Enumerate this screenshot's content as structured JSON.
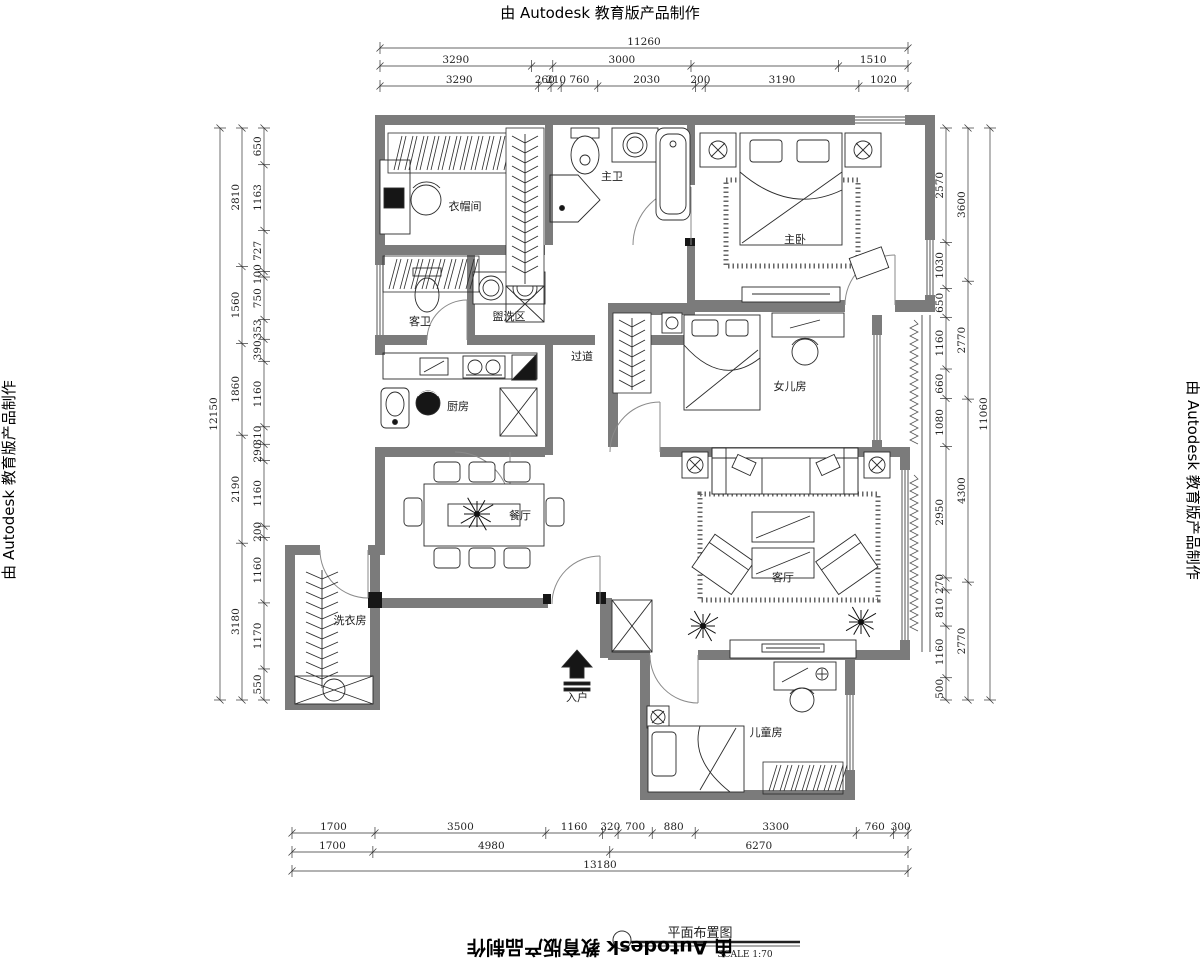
{
  "watermark": {
    "text": "由 Autodesk 教育版产品制作"
  },
  "title": {
    "name": "平面布置图",
    "scale": "SCALE 1:70"
  },
  "rooms": {
    "cloakroom": "衣帽间",
    "master_bath": "主卫",
    "master_bedroom": "主卧",
    "guest_bath": "客卫",
    "wash_area": "盥洗区",
    "corridor": "过道",
    "daughter_room": "女儿房",
    "kitchen": "厨房",
    "dining": "餐厅",
    "living": "客厅",
    "laundry": "洗衣房",
    "entry": "入户",
    "kids_room": "儿童房"
  },
  "colors": {
    "wall": "#7b7b7b",
    "line": "#2b2b2b"
  },
  "dimensions": {
    "top": {
      "total": "11260",
      "row2": [
        "3290",
        "3000",
        "1510"
      ],
      "row3": [
        "3290",
        "260",
        "210",
        "760",
        "2030",
        "200",
        "3190",
        "1020"
      ]
    },
    "bottom": {
      "row1": [
        "1700",
        "3500",
        "1160",
        "320",
        "700",
        "880",
        "3300",
        "760",
        "300"
      ],
      "row2": [
        "1700",
        "4980",
        "6270"
      ],
      "total": "13180"
    },
    "left": {
      "total": "12150",
      "mid": [
        "2810",
        "1560",
        "1860",
        "2190",
        "3180"
      ],
      "inner": [
        "650",
        "1163",
        "727",
        "100",
        "750",
        "353",
        "390",
        "1160",
        "310",
        "290",
        "1160",
        "200",
        "1160",
        "1170",
        "550"
      ]
    },
    "right": {
      "total": "11060",
      "mid": [
        "3600",
        "2770",
        "4300",
        "2770"
      ],
      "inner": [
        "2570",
        "1030",
        "650",
        "1160",
        "660",
        "1080",
        "2950",
        "270",
        "810",
        "1160",
        "500"
      ]
    }
  }
}
